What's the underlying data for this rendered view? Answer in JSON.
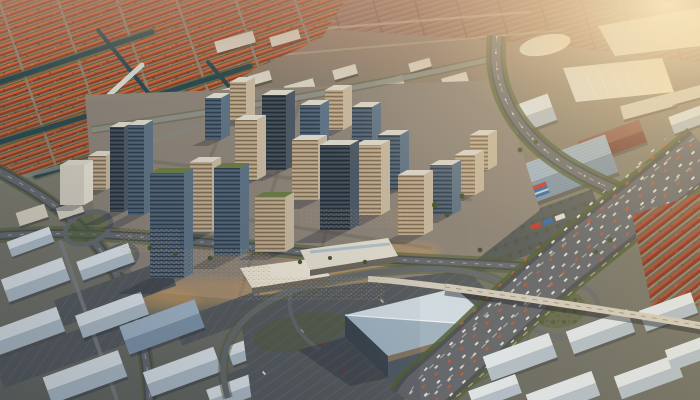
{
  "scene": {
    "type": "aerial-photo-render",
    "description": "High-angle golden-hour aerial view of a sprawling city: terracotta-roofed residential grid with canals in the northwest, a glass-and-tan high-rise downtown core at center, looping freeway interchanges, big-box and warehouse districts to the south and east, pale lakes and heavy golden sun haze in the upper right.",
    "lighting": "low golden sun from upper right, long shadows to lower left",
    "no_visible_text": true
  },
  "palette": {
    "haze_far": "#8f6c5e",
    "haze_gold": "#ecd3a4",
    "sun_core": "#fbe9c0",
    "residential_roof_light": "#c4603a",
    "residential_roof_dark": "#8a3f28",
    "street_tan": "#8a7f6e",
    "greenery": "#4f5d33",
    "canal": "#2c4850",
    "canal_lit": "#cfd8d2",
    "road_dark": "#4b4f52",
    "road_mid": "#64686b",
    "road_light": "#8d8f8a",
    "lane_dash": "#b9b6ad",
    "glass_face": "#46586a",
    "glass_side": "#5d7183",
    "glassdark_face": "#39434e",
    "glassdark_side": "#4c5864",
    "tan_face": "#a89478",
    "tan_side": "#c2b39b",
    "white_face": "#cfc9bc",
    "white_side": "#e2dccd",
    "brick_face": "#7a4438",
    "brick_side": "#8f5242",
    "roof_top": "#d6d2c6",
    "roof_green": "#6a7a45",
    "tower_shadow": "rgba(25,30,45,0.28)",
    "asphalt": "#55595c",
    "warehouse_light": "#dce3e8",
    "warehouse_dark": "#aebcc7",
    "warehouse_blue_light": "#9fb4c6",
    "warehouse_blue_dark": "#7d94a8",
    "warehouse_red_light": "#8a5244",
    "warehouse_red_dark": "#6e3c30",
    "bigbox_roof_light": "#cfdae2",
    "bigbox_roof_dark": "#9fb2c0",
    "lake": "#d7dcd8",
    "window_glow": "#e8a658",
    "container_blue": "#2f66a8",
    "container_red": "#c0392b",
    "cars_white": "#eceadf",
    "cars_orange": "#c4572f",
    "bridge_deck": "#cfc9ba",
    "distant_build": "#d3cdbd"
  },
  "landmarks": [
    {
      "name": "residential-district-nw",
      "desc": "dense diagonal rows of orange terracotta roofs with tree lines and dark canals"
    },
    {
      "name": "downtown-core",
      "desc": "cluster of glass and tan office towers, several with green roofs and warm lit streets"
    },
    {
      "name": "main-freeway",
      "desc": "wide multi-lane freeway full of traffic crossing the lower right"
    },
    {
      "name": "overpass-bridge",
      "desc": "pale concrete overpass crossing the freeway diagonally"
    },
    {
      "name": "big-box-building",
      "desc": "large blue-roofed building in an empty parking lot ringed by ramp loops"
    },
    {
      "name": "warehouse-district-sw",
      "desc": "rows of gabled warehouses with pale blue-white roofs and parking lots"
    },
    {
      "name": "warehouse-district-se",
      "desc": "rows of white-roofed warehouses beyond the freeway"
    },
    {
      "name": "logistics-park-east",
      "desc": "large ribbed blue warehouses, a blue container building and tree-lined lots"
    },
    {
      "name": "red-roof-houses-east",
      "desc": "strip of red gabled row-houses beside the freeway"
    },
    {
      "name": "marina-lake",
      "desc": "pale sunlit lake with boat docks"
    },
    {
      "name": "sun-glare",
      "desc": "golden haze washing out the upper-right corner"
    }
  ]
}
